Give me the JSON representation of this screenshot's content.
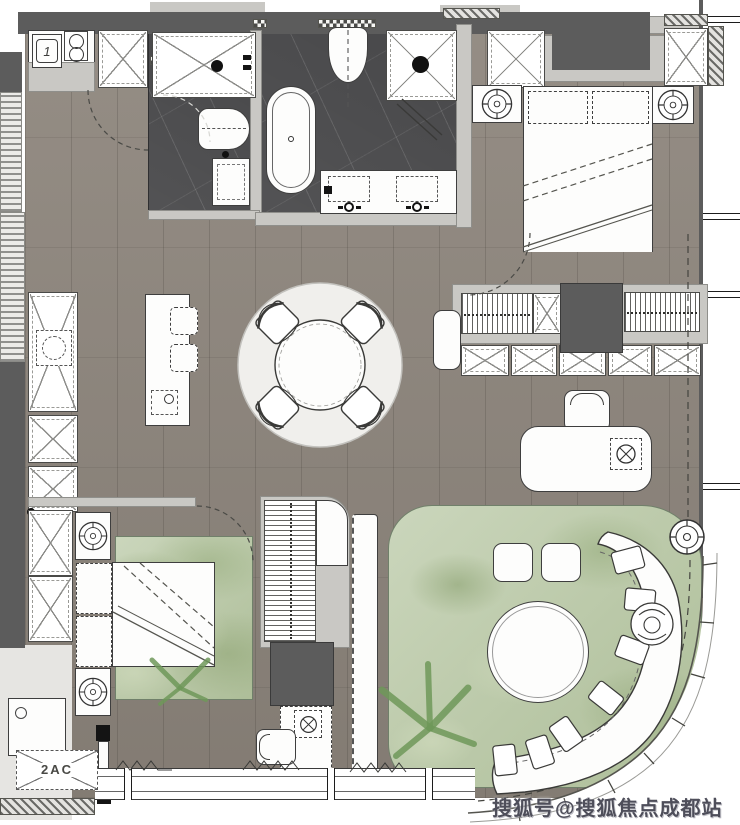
{
  "labels": {
    "kitchen_sink": "1",
    "ac_unit": "2AC"
  },
  "watermark": {
    "text": "搜狐号@搜狐焦点成都站"
  },
  "symbols": {
    "ceiling_lamp": "circle-cross-icon",
    "desk_lamp": "circle-x-in-dashed-square-icon",
    "cabinet": "x-box-icon",
    "wardrobe": "hanging-clothes-hatch-icon",
    "ac": "dashed-x-box-icon"
  },
  "colors": {
    "wood": "#8e867d",
    "marble": "#48484a",
    "wall-dark": "#5c5c5c",
    "wall-light": "#c9c8c4",
    "wall-lighter": "#e6e5e2",
    "rug-green": "#b7c6a5",
    "rug-round": "#f0efec",
    "ink": "#3e3e3e",
    "watermark": "#4e4e5a"
  }
}
